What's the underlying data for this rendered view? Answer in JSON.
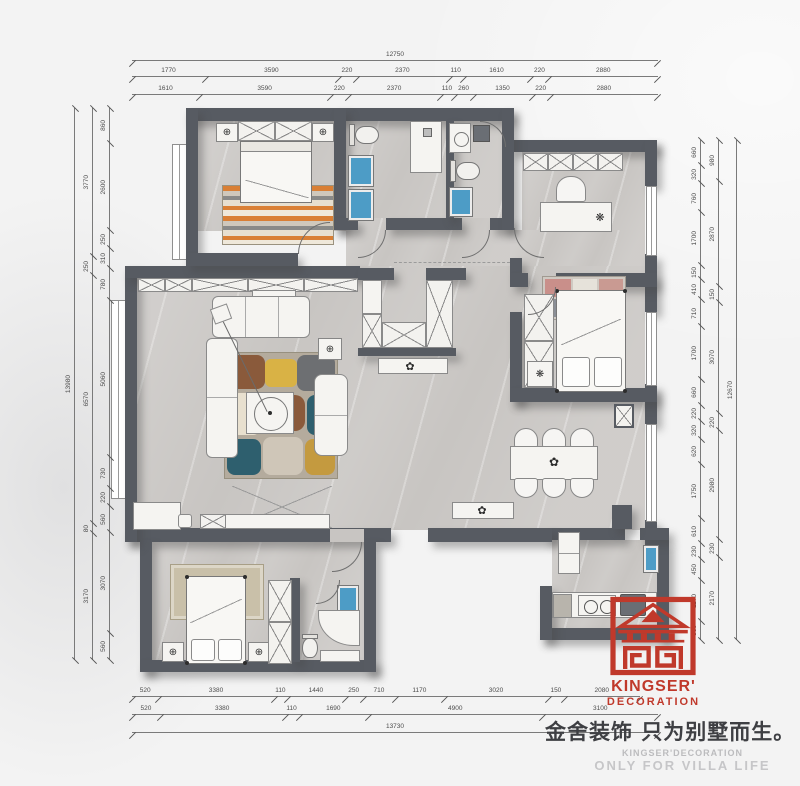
{
  "brand": {
    "logo_line1": "KINGSER'",
    "logo_line2": "DECORATION",
    "slogan_cn": "金舍装饰 只为别墅而生。",
    "sub_line1": "KINGSER'DECORATION",
    "sub_line2": "ONLY FOR VILLA LIFE",
    "logo_red": "#c0392b",
    "slogan_color": "#3e3f43",
    "sub_color": "#bcbcbe"
  },
  "icons": {
    "lamp": "⊕",
    "plant": "✿",
    "fan": "❋"
  },
  "dimensions": {
    "top": {
      "total": [
        "12750"
      ],
      "row1": [
        "1770",
        "3590",
        "220",
        "2370",
        "110",
        "1610",
        "220",
        "2880"
      ],
      "row2": [
        "1610",
        "3590",
        "220",
        "2370",
        "110",
        "260",
        "1350",
        "220",
        "2880"
      ]
    },
    "bottom": {
      "row1": [
        "520",
        "3380",
        "110",
        "1440",
        "250",
        "710",
        "1170",
        "3020",
        "150",
        "2080"
      ],
      "row2": [
        "520",
        "3380",
        "110",
        "1690",
        "4900",
        "3100"
      ],
      "total": [
        "13730"
      ]
    },
    "left": {
      "outer": [
        "13980"
      ],
      "middle": [
        "3770",
        "250",
        "6570",
        "80",
        "3170"
      ],
      "inner": [
        "860",
        "2600",
        "250",
        "310",
        "780",
        "5060",
        "730",
        "220",
        "560",
        "3070",
        "560"
      ]
    },
    "right": {
      "inner": [
        "660",
        "320",
        "760",
        "1700",
        "150",
        "410",
        "710",
        "1700",
        "660",
        "220",
        "320",
        "620",
        "1750",
        "610",
        "230",
        "450",
        "1170",
        "360"
      ],
      "middle": [
        "980",
        "2870",
        "150",
        "3070",
        "220",
        "2980",
        "230",
        "2170"
      ],
      "outer": [
        "12670"
      ]
    }
  }
}
